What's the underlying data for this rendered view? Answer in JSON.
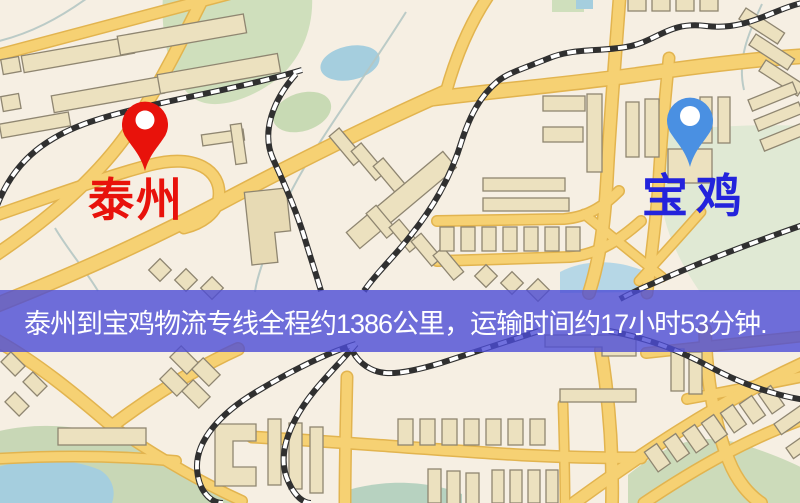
{
  "banner": {
    "text": "泰州到宝鸡物流专线全程约1386公里，运输时间约17小时53分钟.",
    "background_color": "#4c4cd6",
    "text_color": "#ffffff"
  },
  "map": {
    "origin": {
      "label": "泰州",
      "pin_color": "#e8120b",
      "label_color": "#e8120b"
    },
    "destination": {
      "label": "宝鸡",
      "pin_color": "#4a90e2",
      "label_color": "#2323dc"
    },
    "palette": {
      "background": "#f6efe3",
      "road": "#f6d173",
      "road_edge": "#e2b44f",
      "railway": "#303030",
      "building_fill": "#ece1bf",
      "building_outline": "#8f8671",
      "park": "#cfdfbc",
      "water": "#a5cede"
    }
  }
}
